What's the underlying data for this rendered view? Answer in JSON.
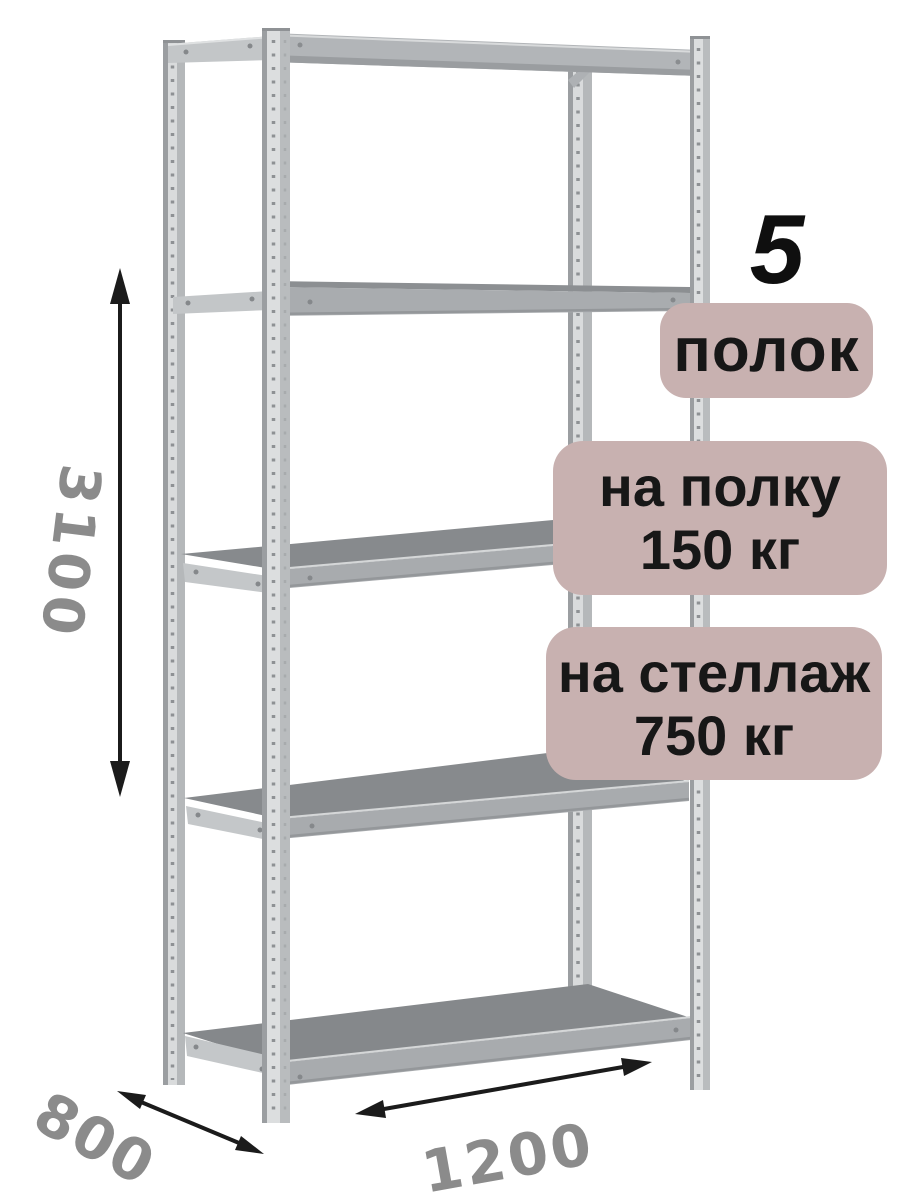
{
  "badges": {
    "shelf_count": {
      "number": "5",
      "label": "полок"
    },
    "shelf_load": {
      "line1": "на полку",
      "line2": "150 кг"
    },
    "rack_load": {
      "line1": "на стеллаж",
      "line2": "750 кг"
    }
  },
  "dimensions": {
    "height": "3100",
    "depth": "800",
    "width": "1200"
  },
  "colors": {
    "badge_bg": "#c8b1b0",
    "badge_text": "#171717",
    "dim_text": "#8b8b8b",
    "arrow": "#1b1b1b"
  }
}
